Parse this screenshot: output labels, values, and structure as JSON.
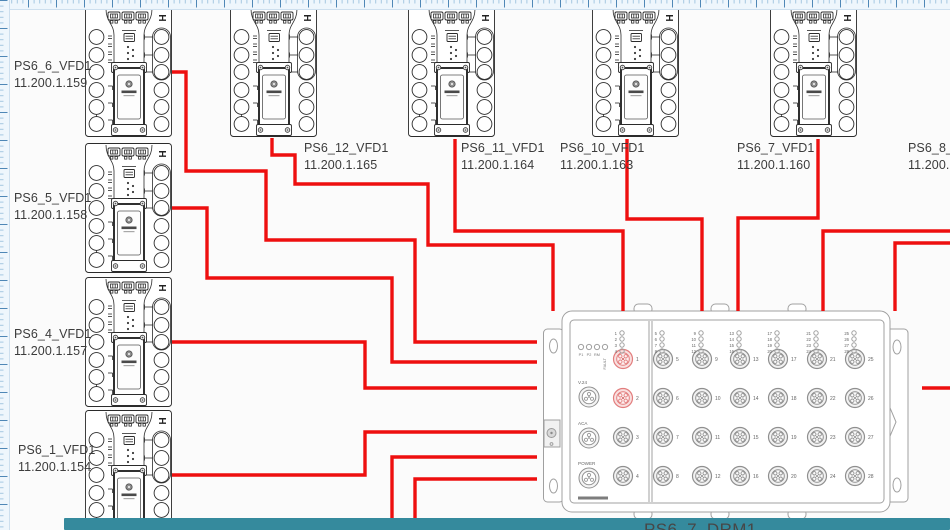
{
  "diagram": {
    "background": "#fbfbfb",
    "wire_color": "#ee0f0f",
    "device_stroke": "#2b2b2b",
    "switch_stroke": "#a0a0a0",
    "highlight_port_color": "#e27d7d",
    "label_color": "#3c3c3c"
  },
  "scrollbar": {
    "x": 64,
    "y": 518,
    "width": 886,
    "height": 12,
    "color": "#358a9d"
  },
  "devices": [
    {
      "id": "ps6_6",
      "name": "PS6_6_VFD1",
      "ip": "11.200.1.159",
      "x": 85,
      "y": 7,
      "label": {
        "x": 14,
        "y": 58
      }
    },
    {
      "id": "ps6_5",
      "name": "PS6_5_VFD1",
      "ip": "11.200.1.158",
      "x": 85,
      "y": 143,
      "label": {
        "x": 14,
        "y": 190
      }
    },
    {
      "id": "ps6_4",
      "name": "PS6_4_VFD1",
      "ip": "11.200.1.157",
      "x": 85,
      "y": 277,
      "label": {
        "x": 14,
        "y": 326
      }
    },
    {
      "id": "ps6_1",
      "name": "PS6_1_VFD1",
      "ip": "11.200.1.154",
      "x": 85,
      "y": 410,
      "label": {
        "x": 18,
        "y": 442
      }
    },
    {
      "id": "ps6_12",
      "name": "PS6_12_VFD1",
      "ip": "11.200.1.165",
      "x": 230,
      "y": 7,
      "label": {
        "x": 304,
        "y": 140
      }
    },
    {
      "id": "ps6_11",
      "name": "PS6_11_VFD1",
      "ip": "11.200.1.164",
      "x": 408,
      "y": 7,
      "label": {
        "x": 461,
        "y": 140
      }
    },
    {
      "id": "ps6_10",
      "name": "PS6_10_VFD1",
      "ip": "11.200.1.163",
      "x": 592,
      "y": 7,
      "label": {
        "x": 560,
        "y": 140
      }
    },
    {
      "id": "ps6_7",
      "name": "PS6_7_VFD1",
      "ip": "11.200.1.160",
      "x": 770,
      "y": 7,
      "label": {
        "x": 737,
        "y": 140
      }
    },
    {
      "id": "ps6_8",
      "name": "PS6_8_VF",
      "ip": "11.200.1.",
      "offscreen": true,
      "label": {
        "x": 908,
        "y": 140
      }
    }
  ],
  "wires": [
    {
      "id": "wire-ps6_6-switch",
      "points": [
        [
          172,
          72
        ],
        [
          186,
          72
        ],
        [
          186,
          171
        ],
        [
          266,
          171
        ],
        [
          266,
          240
        ],
        [
          415,
          240
        ],
        [
          415,
          342
        ],
        [
          537,
          342
        ]
      ]
    },
    {
      "id": "wire-ps6_5-switch",
      "points": [
        [
          172,
          208
        ],
        [
          207,
          208
        ],
        [
          207,
          278
        ],
        [
          392,
          278
        ],
        [
          392,
          362
        ],
        [
          537,
          362
        ]
      ]
    },
    {
      "id": "wire-ps6_4-switch",
      "points": [
        [
          172,
          342
        ],
        [
          365,
          342
        ],
        [
          365,
          388
        ],
        [
          537,
          388
        ]
      ]
    },
    {
      "id": "wire-ps6_1-switch",
      "points": [
        [
          172,
          475
        ],
        [
          365,
          475
        ],
        [
          365,
          432
        ],
        [
          537,
          432
        ]
      ]
    },
    {
      "id": "wire-bottom-1",
      "points": [
        [
          392,
          532
        ],
        [
          392,
          457
        ],
        [
          537,
          457
        ]
      ]
    },
    {
      "id": "wire-bottom-2",
      "points": [
        [
          415,
          532
        ],
        [
          415,
          479
        ],
        [
          537,
          479
        ]
      ]
    },
    {
      "id": "wire-ps6_12-switch",
      "points": [
        [
          272,
          138
        ],
        [
          272,
          155
        ],
        [
          295,
          155
        ],
        [
          295,
          184
        ],
        [
          428,
          184
        ],
        [
          428,
          245
        ],
        [
          553,
          245
        ],
        [
          553,
          311
        ]
      ]
    },
    {
      "id": "wire-ps6_11-switch",
      "points": [
        [
          455,
          139
        ],
        [
          455,
          231
        ],
        [
          623,
          231
        ],
        [
          623,
          311
        ]
      ]
    },
    {
      "id": "wire-ps6_10-switch",
      "points": [
        [
          627,
          139
        ],
        [
          627,
          219
        ],
        [
          702,
          219
        ],
        [
          702,
          311
        ]
      ]
    },
    {
      "id": "wire-ps6_7-switch",
      "points": [
        [
          818,
          139
        ],
        [
          818,
          218
        ],
        [
          738,
          218
        ],
        [
          738,
          311
        ]
      ]
    },
    {
      "id": "wire-right-1",
      "points": [
        [
          952,
          231
        ],
        [
          823,
          231
        ],
        [
          823,
          311
        ]
      ]
    },
    {
      "id": "wire-right-2",
      "points": [
        [
          952,
          243
        ],
        [
          895,
          243
        ],
        [
          895,
          311
        ]
      ]
    },
    {
      "id": "wire-right-3",
      "points": [
        [
          952,
          388
        ],
        [
          922,
          388
        ]
      ]
    }
  ],
  "switch": {
    "label": "PS6_7_DRM1",
    "label_pos": {
      "x": 644,
      "y": 520
    },
    "system_leds": [
      "P1",
      "P2",
      "RM",
      "FAULT"
    ],
    "system_ports": [
      "V.24",
      "ACA",
      "POWER"
    ],
    "highlighted_ports": [
      1,
      2
    ],
    "port_columns": [
      [
        1,
        2,
        3,
        4
      ],
      [
        5,
        6,
        7,
        8
      ],
      [
        9,
        10,
        11,
        12
      ],
      [
        13,
        14,
        15,
        16
      ],
      [
        17,
        18,
        19,
        20
      ],
      [
        21,
        22,
        23,
        24
      ],
      [
        25,
        26,
        27,
        28
      ]
    ]
  }
}
